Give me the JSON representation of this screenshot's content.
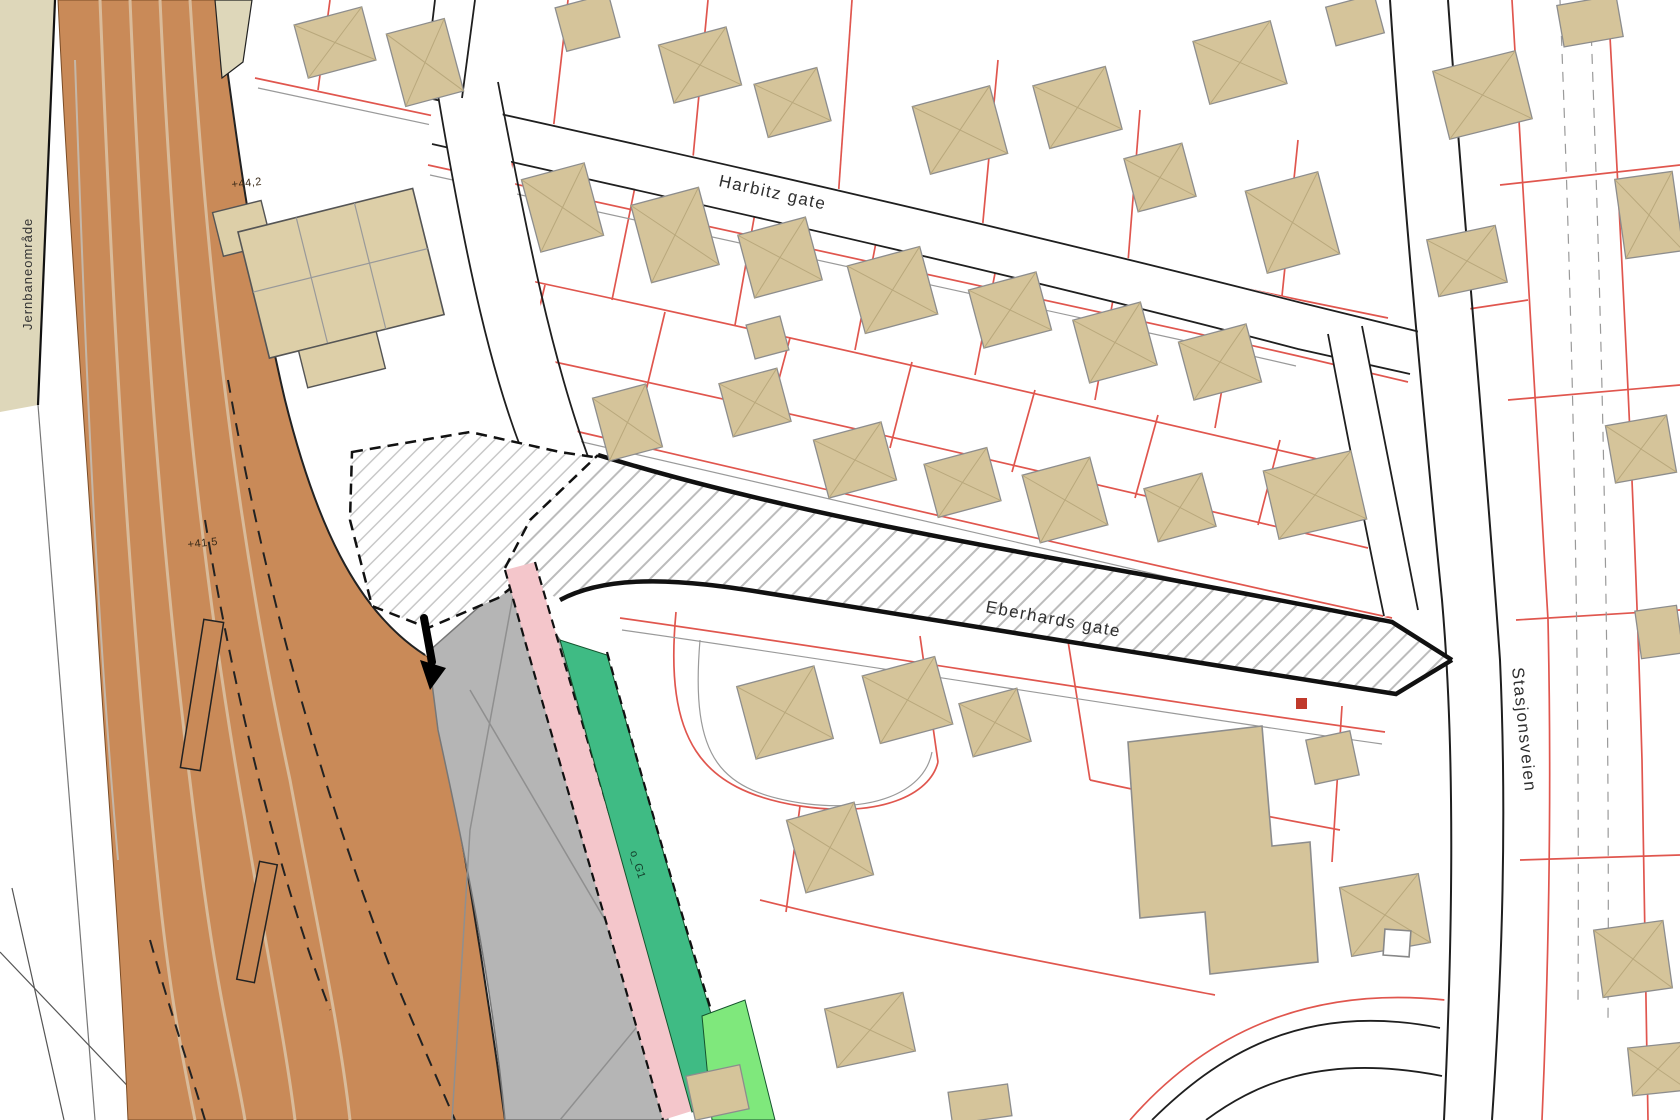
{
  "labels": {
    "street_top": "Harbitz gate",
    "street_pedestrian": "Eberhards gate",
    "street_right": "Stasjonsveien",
    "railway_area": "Jernbaneområde",
    "elevation_upper": "+44,2",
    "elevation_lower": "+41,5",
    "green_zone": "o_G1"
  },
  "colors": {
    "railway_band": "#c98a58",
    "railway_stripe": "#d9bb9a",
    "parcel_line": "#e0564e",
    "building_fill": "#d5c49a",
    "building_ridge": "#b9a87c",
    "building_stroke": "#8d8d8d",
    "station_fill": "#ddcfa8",
    "platform_gray": "#b5b5b5",
    "sidewalk_pink": "#f4c6cb",
    "green_corridor": "#3fbb84",
    "park_green": "#7fe87c",
    "left_margin_beige": "#ded7ba",
    "road_casing": "#1f1f1f",
    "hatch_line": "#bcbcbc"
  }
}
